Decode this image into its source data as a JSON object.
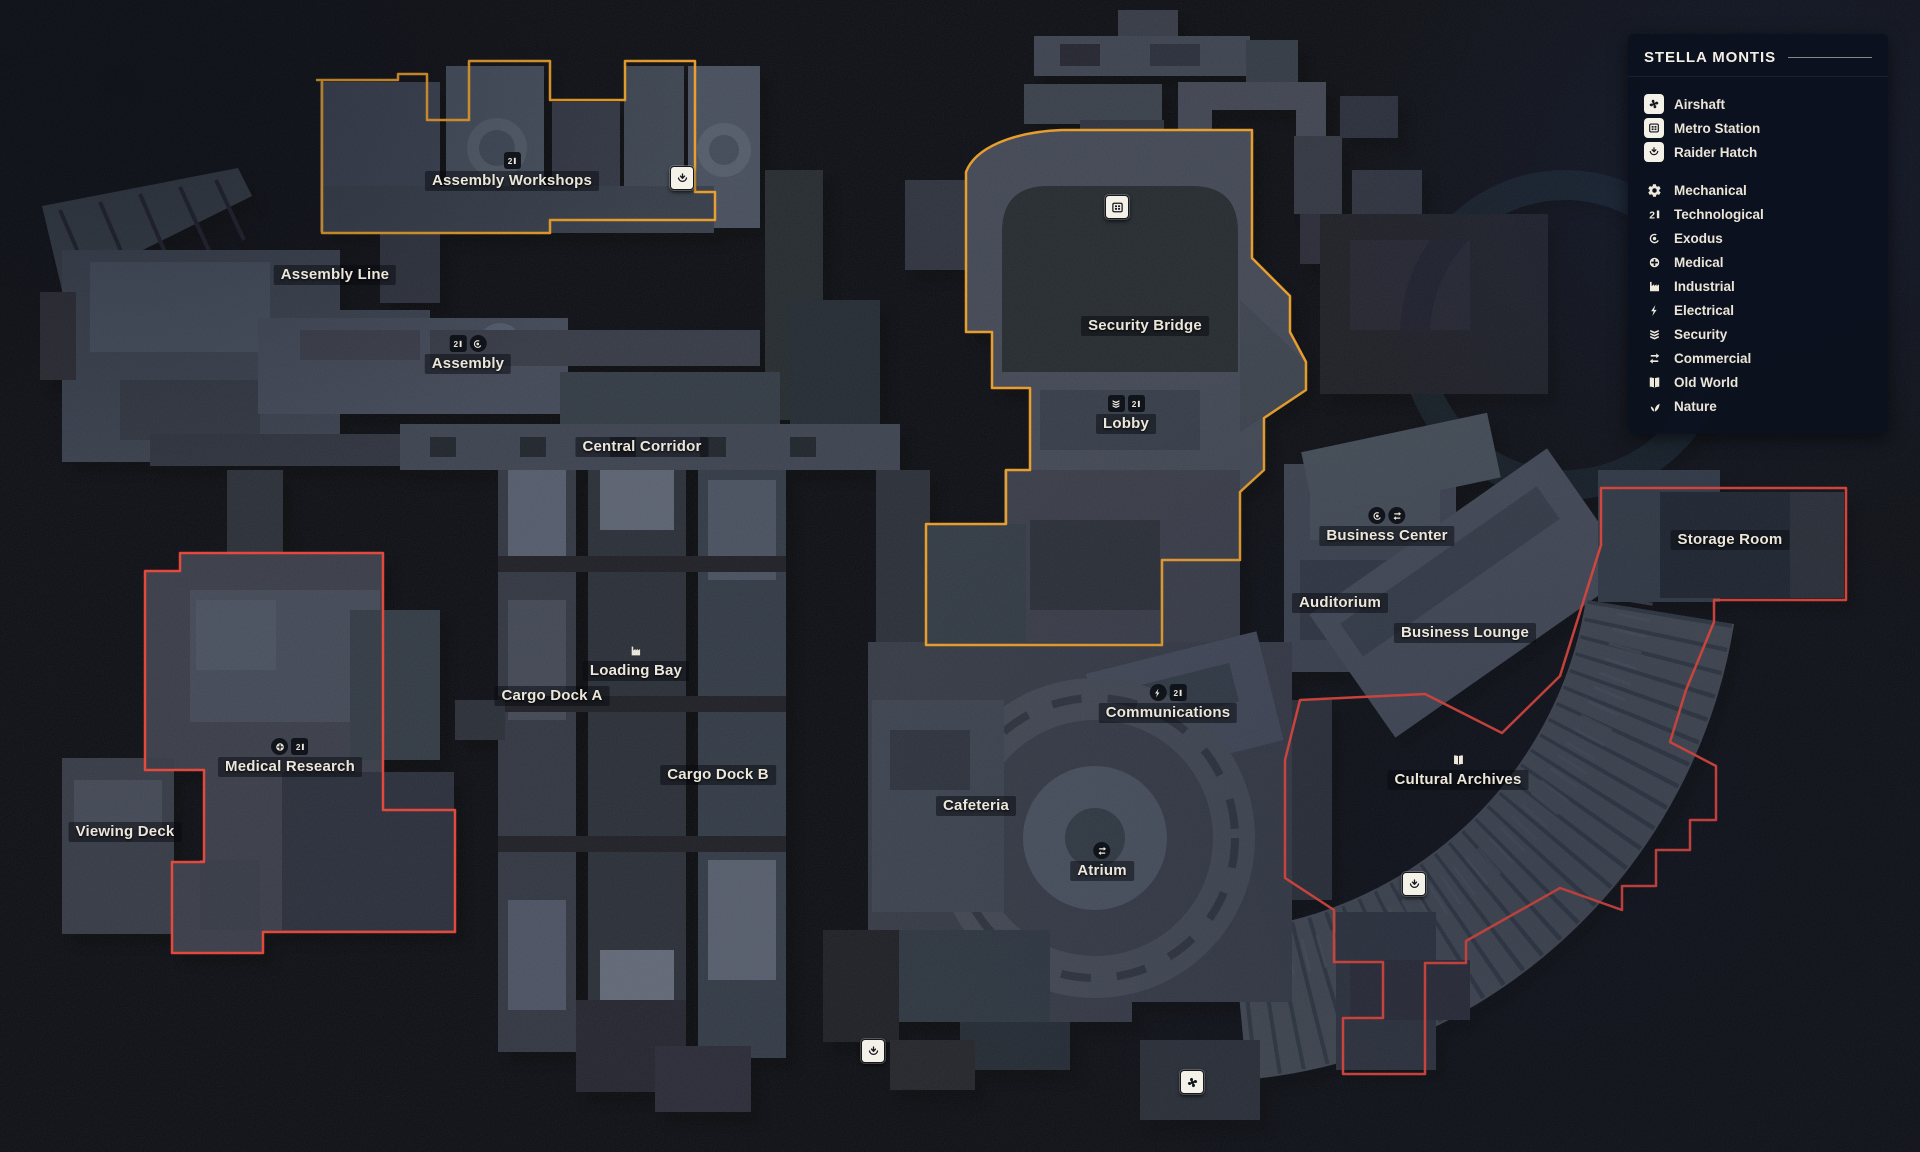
{
  "panel": {
    "title": "STELLA MONTIS",
    "special": [
      {
        "id": "airshaft",
        "icon": "airshaft",
        "label": "Airshaft"
      },
      {
        "id": "metro-station",
        "icon": "metro-station",
        "label": "Metro Station"
      },
      {
        "id": "raider-hatch",
        "icon": "raider-hatch",
        "label": "Raider Hatch"
      }
    ],
    "districts": [
      {
        "id": "mechanical",
        "icon": "mechanical",
        "label": "Mechanical"
      },
      {
        "id": "technological",
        "icon": "technological",
        "label": "Technological"
      },
      {
        "id": "exodus",
        "icon": "exodus",
        "label": "Exodus"
      },
      {
        "id": "medical",
        "icon": "medical",
        "label": "Medical"
      },
      {
        "id": "industrial",
        "icon": "industrial",
        "label": "Industrial"
      },
      {
        "id": "electrical",
        "icon": "electrical",
        "label": "Electrical"
      },
      {
        "id": "security",
        "icon": "security",
        "label": "Security"
      },
      {
        "id": "commercial",
        "icon": "commercial",
        "label": "Commercial"
      },
      {
        "id": "old-world",
        "icon": "old-world",
        "label": "Old World"
      },
      {
        "id": "nature",
        "icon": "nature",
        "label": "Nature"
      }
    ]
  },
  "map": {
    "labels": [
      {
        "id": "assembly-workshops",
        "text": "Assembly Workshops",
        "x": 512,
        "y": 181,
        "badges": [
          {
            "icon": "technological",
            "shape": "square"
          }
        ]
      },
      {
        "id": "assembly-line",
        "text": "Assembly Line",
        "x": 335,
        "y": 275,
        "badges": []
      },
      {
        "id": "assembly",
        "text": "Assembly",
        "x": 468,
        "y": 364,
        "badges": [
          {
            "icon": "technological",
            "shape": "square"
          },
          {
            "icon": "exodus",
            "shape": "circle"
          }
        ]
      },
      {
        "id": "central-corridor",
        "text": "Central Corridor",
        "x": 642,
        "y": 447,
        "badges": []
      },
      {
        "id": "security-bridge",
        "text": "Security Bridge",
        "x": 1145,
        "y": 326,
        "badges": []
      },
      {
        "id": "lobby",
        "text": "Lobby",
        "x": 1126,
        "y": 424,
        "badges": [
          {
            "icon": "security",
            "shape": "square"
          },
          {
            "icon": "technological",
            "shape": "square"
          }
        ]
      },
      {
        "id": "business-center",
        "text": "Business Center",
        "x": 1387,
        "y": 536,
        "badges": [
          {
            "icon": "exodus",
            "shape": "circle"
          },
          {
            "icon": "commercial",
            "shape": "circle"
          }
        ]
      },
      {
        "id": "auditorium",
        "text": "Auditorium",
        "x": 1340,
        "y": 603,
        "badges": []
      },
      {
        "id": "business-lounge",
        "text": "Business Lounge",
        "x": 1465,
        "y": 633,
        "badges": []
      },
      {
        "id": "storage-room",
        "text": "Storage Room",
        "x": 1730,
        "y": 540,
        "badges": []
      },
      {
        "id": "medical-research",
        "text": "Medical Research",
        "x": 290,
        "y": 767,
        "badges": [
          {
            "icon": "medical",
            "shape": "circle"
          },
          {
            "icon": "technological",
            "shape": "square"
          }
        ]
      },
      {
        "id": "viewing-deck",
        "text": "Viewing Deck",
        "x": 125,
        "y": 832,
        "badges": []
      },
      {
        "id": "cargo-dock-a",
        "text": "Cargo Dock A",
        "x": 552,
        "y": 696,
        "badges": []
      },
      {
        "id": "loading-bay",
        "text": "Loading Bay",
        "x": 636,
        "y": 671,
        "badges": [
          {
            "icon": "industrial",
            "shape": "bare"
          }
        ]
      },
      {
        "id": "cargo-dock-b",
        "text": "Cargo Dock B",
        "x": 718,
        "y": 775,
        "badges": []
      },
      {
        "id": "cafeteria",
        "text": "Cafeteria",
        "x": 976,
        "y": 806,
        "badges": []
      },
      {
        "id": "communications",
        "text": "Communications",
        "x": 1168,
        "y": 713,
        "badges": [
          {
            "icon": "electrical",
            "shape": "circle"
          },
          {
            "icon": "technological",
            "shape": "square"
          }
        ]
      },
      {
        "id": "atrium",
        "text": "Atrium",
        "x": 1102,
        "y": 871,
        "badges": [
          {
            "icon": "commercial",
            "shape": "circle"
          }
        ]
      },
      {
        "id": "cultural-archives",
        "text": "Cultural Archives",
        "x": 1458,
        "y": 780,
        "badges": [
          {
            "icon": "old-world",
            "shape": "bare"
          }
        ]
      }
    ],
    "markers": [
      {
        "icon": "raider-hatch",
        "x": 682,
        "y": 178
      },
      {
        "icon": "metro-station",
        "x": 1117,
        "y": 207
      },
      {
        "icon": "raider-hatch",
        "x": 1414,
        "y": 884
      },
      {
        "icon": "raider-hatch",
        "x": 873,
        "y": 1051
      },
      {
        "icon": "airshaft",
        "x": 1192,
        "y": 1082
      }
    ],
    "regions": [
      {
        "id": "assembly-workshops",
        "label": "Assembly Workshops",
        "color": "#f1a42d"
      },
      {
        "id": "security-bridge",
        "label": "Security Bridge / Lobby",
        "color": "#f1a42d"
      },
      {
        "id": "medical-research",
        "label": "Medical Research",
        "color": "#ee4b3e"
      },
      {
        "id": "storage-cultural",
        "label": "Storage Room / Cultural Archives",
        "color": "#ee4b3e"
      }
    ]
  },
  "colors": {
    "accent_yellow": "#f1a42d",
    "accent_red": "#ee4b3e",
    "text_cream": "#ece7da",
    "panel_bg": "#0c111f"
  }
}
